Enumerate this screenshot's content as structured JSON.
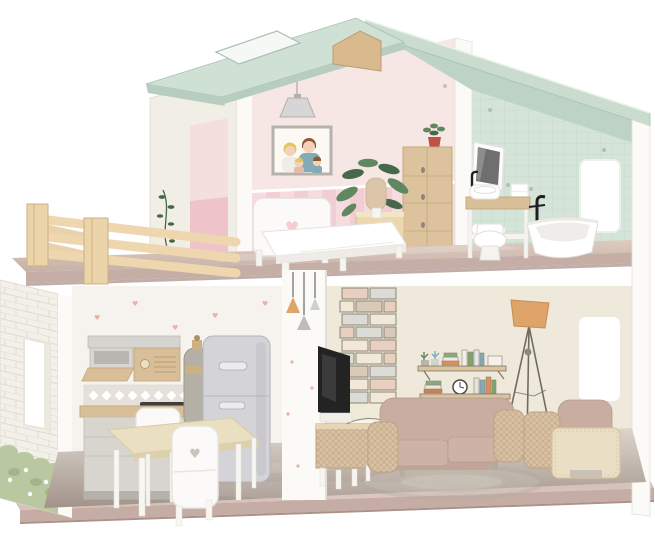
{
  "meta": {
    "type": "product-photo",
    "background": "#ffffff",
    "label": "Two-story wooden dollhouse with mint gable roof, balcony and miniature furniture"
  },
  "palette": {
    "roof_top": "#cfe0d4",
    "roof_edge": "#b6cdbf",
    "roof_face": "#c9dccd",
    "roof_under": "#bdd3c5",
    "beam": "#d9ba8e",
    "white_warm": "#f1eee6",
    "white_bright": "#fbfaf7",
    "pink_wall": "#f7e7e4",
    "pink_stripe_a": "#f2cdd3",
    "pink_stripe_b": "#f7dcdf",
    "pink_door": "#eec3ca",
    "mint_wall": "#d5e4d9",
    "mint_line": "#c3d6c8",
    "cream_wall": "#eee9da",
    "kitchen_wall": "#f6f3ee",
    "slab_top": "#d3bfb6",
    "slab_front": "#c5aea5",
    "base_top": "#d7c2ba",
    "base_front": "#c5aca4",
    "floor_light": "#dcd5cc",
    "floor_dark": "#a2938a",
    "furn_white": "#fbfaf8",
    "furn_line": "#e3dfda",
    "wood_light": "#ecd7b0",
    "wood_mid": "#d9bf98",
    "wood_dark": "#c2a27a",
    "sofa": "#c8ada0",
    "sofa_dark": "#b4998c",
    "cushion": "#cdb3a6",
    "wicker": "#d8c2a5",
    "wicker_line": "#bfa27f",
    "cream_panel": "#eadec5",
    "fridge": "#d4d4d8",
    "fridge_line": "#b2b2b8",
    "gray_cab": "#d6d4d0",
    "orange": "#dfa469",
    "green": "#5f8760",
    "green_dark": "#47684a",
    "grass": "#b9c8a1",
    "grass_dark": "#9fb289",
    "heart": "#eab2a4",
    "metal": "#bdbdbd",
    "black": "#232323",
    "red_pot": "#c05244",
    "teal": "#84aab6",
    "skin": "#f3d2b8",
    "hair_yellow": "#e7c45c",
    "hair_brown": "#8a5a38"
  },
  "scene": {
    "label": "Wooden dollhouse product photo",
    "roof": {
      "label": "mint green gable roof with skylight opening"
    },
    "balcony": {
      "label": "balcony with natural wood fence",
      "posts": 2,
      "rails": 3
    },
    "upper": {
      "bedroom": {
        "label": "bedroom with pink striped wainscot",
        "furniture": [
          "family portrait",
          "pendant lamp",
          "white bed with heart headboard",
          "wooden nightstand",
          "table lamp",
          "potted plant",
          "tan wardrobe with plant on top"
        ]
      },
      "bathroom": {
        "label": "bathroom with mint tiled walls",
        "furniture": [
          "mirror",
          "towel",
          "washbasin with black faucet",
          "wooden vanity with towels",
          "toilet",
          "freestanding bathtub with black faucet",
          "window"
        ]
      }
    },
    "ground": {
      "kitchen": {
        "label": "kitchen with tiny-heart wallpaper",
        "furniture": [
          "wall cabinet with range hood",
          "radio-front cabinet",
          "diamond tile backsplash",
          "counter with stove",
          "base cabinet",
          "gas cylinder",
          "gray refrigerator",
          "wooden dining table",
          "two white chairs with heart cutout"
        ]
      },
      "living_room": {
        "label": "living room with printed brick chimney and shelves",
        "furniture": [
          "flat TV",
          "rattan TV stand",
          "taupe sofa with rattan arms",
          "armchair with cream slipcover",
          "tripod floor lamp with orange shade",
          "printed wall shelves with books and clock",
          "printed round rug",
          "window"
        ]
      }
    },
    "base": {
      "label": "taupe base platform"
    }
  }
}
